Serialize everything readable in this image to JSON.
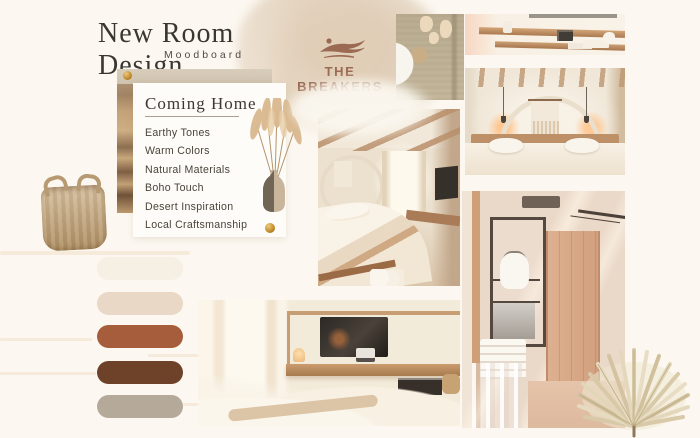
{
  "header": {
    "title": "New Room Design",
    "subtitle": "Moodboard",
    "brand": {
      "name": "THE BREAKERS",
      "icon": "leaping-horse-icon"
    }
  },
  "concept_card": {
    "title": "Coming Home",
    "items": [
      "Earthy Tones",
      "Warm Colors",
      "Natural Materials",
      "Boho Touch",
      "Desert Inspiration",
      "Local Craftsmanship"
    ]
  },
  "palette": {
    "colors": [
      "#f6efe4",
      "#e9d8c5",
      "#a65d3c",
      "#6d4229",
      "#b5a999"
    ],
    "accent_gold": "#c08a2a"
  }
}
